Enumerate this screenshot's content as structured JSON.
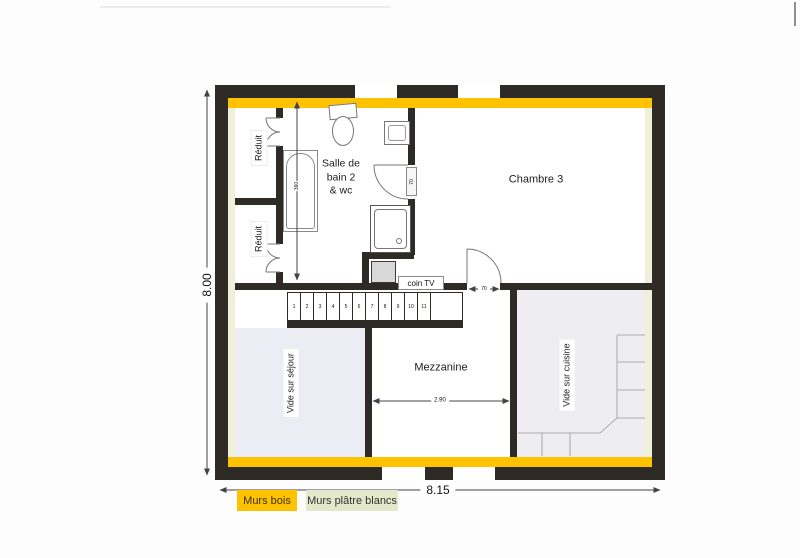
{
  "plan": {
    "rooms": {
      "chambre3": "Chambre 3",
      "bathroom_line1": "Salle de",
      "bathroom_line2": "bain 2",
      "bathroom_line3": "& wc",
      "reduit_top": "Réduit",
      "reduit_bottom": "Réduit",
      "mezzanine": "Mezzanine",
      "vide_sejour": "Vide sur séjour",
      "vide_cuisine": "Vide sur cuisine",
      "coin_tv": "coin TV"
    },
    "dimensions": {
      "overall_height_m": "8.00",
      "overall_width_m": "8.15",
      "mezzanine_width_m": "2.90",
      "bathroom_depth": "360",
      "bathroom_door": "70",
      "chambre_door": "70"
    },
    "stairs": {
      "steps": [
        "1",
        "2",
        "3",
        "4",
        "5",
        "6",
        "7",
        "8",
        "9",
        "10",
        "11"
      ]
    },
    "legend": {
      "wood_walls": {
        "label": "Murs bois",
        "color": "#ffc200"
      },
      "plaster_walls": {
        "label": "Murs plâtre blancs",
        "color": "#e3e8ca"
      }
    },
    "colors": {
      "wall": "#2e2b27",
      "wood_strip": "#ffc200",
      "plaster_strip": "#eef0da",
      "void_fill": "#ececf4"
    }
  }
}
